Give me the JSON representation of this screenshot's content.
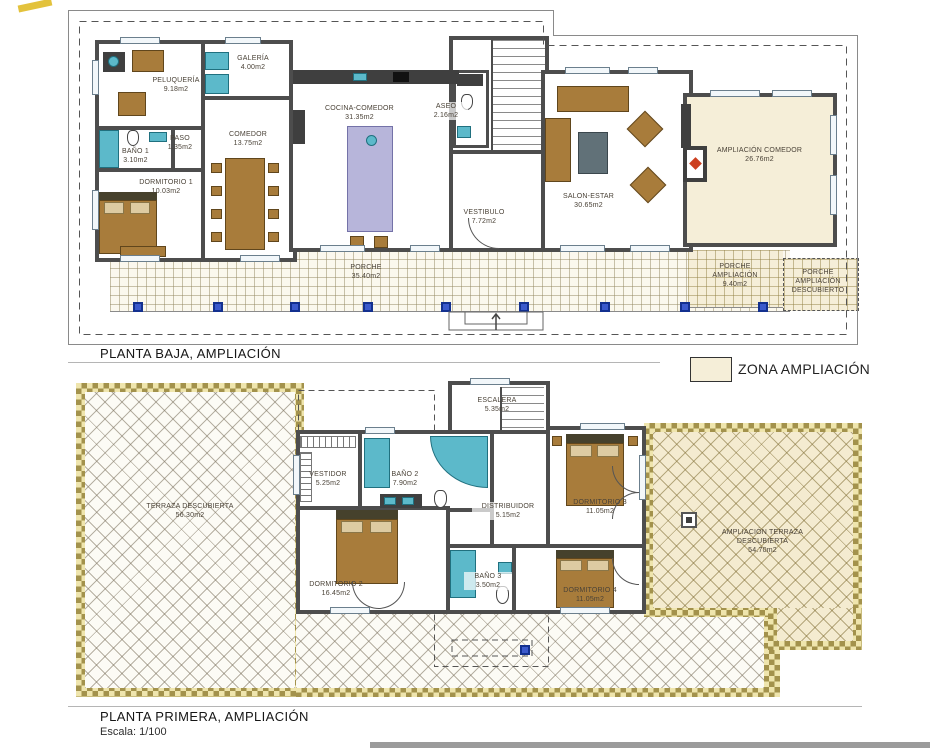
{
  "titles": {
    "plan1": "PLANTA BAJA, AMPLIACIÓN",
    "plan2": "PLANTA PRIMERA, AMPLIACIÓN",
    "scale": "Escala: 1/100"
  },
  "legend": {
    "label": "ZONA AMPLIACIÓN",
    "swatch_color": "#F5EED8"
  },
  "colors": {
    "wall": "#4D4D4D",
    "ampliacion_fill": "#F5EED8",
    "terrace_border_gold": "#A3924C",
    "fixture_teal": "#5CB9CA",
    "furniture_brown": "#A87C3B",
    "column_blue": "#3B59CC"
  },
  "plan1": {
    "rooms": {
      "peluqueria": {
        "name": "PELUQUERÍA",
        "area": "9.18m2"
      },
      "galeria": {
        "name": "GALERÍA",
        "area": "4.00m2"
      },
      "paso": {
        "name": "PASO",
        "area": "1.35m2"
      },
      "bano1": {
        "name": "BAÑO 1",
        "area": "3.10m2"
      },
      "dormitorio1": {
        "name": "DORMITORIO 1",
        "area": "10.03m2"
      },
      "comedor": {
        "name": "COMEDOR",
        "area": "13.75m2"
      },
      "cocina": {
        "name": "COCINA-COMEDOR",
        "area": "31.35m2"
      },
      "aseo": {
        "name": "ASEO",
        "area": "2.16m2"
      },
      "vestibulo": {
        "name": "VESTIBULO",
        "area": "7.72m2"
      },
      "salon": {
        "name": "SALON-ESTAR",
        "area": "30.65m2"
      },
      "ampliacion_comedor": {
        "name": "AMPLIACIÓN COMEDOR",
        "area": "26.76m2"
      },
      "porche": {
        "name": "PORCHE",
        "area": "35.40m2"
      },
      "porche_ampliacion": {
        "name": "PORCHE AMPLIACIÓN",
        "area": "9.40m2"
      },
      "porche_descubierto": {
        "name": "PORCHE AMPLIACIÓN DESCUBIERTO",
        "area": ""
      }
    }
  },
  "plan2": {
    "rooms": {
      "escalera": {
        "name": "ESCALERA",
        "area": "5.35m2"
      },
      "vestidor": {
        "name": "VESTIDOR",
        "area": "5.25m2"
      },
      "bano2": {
        "name": "BAÑO 2",
        "area": "7.90m2"
      },
      "distribuidor": {
        "name": "DISTRIBUIDOR",
        "area": "5.15m2"
      },
      "dormitorio3": {
        "name": "DORMITORIO 3",
        "area": "11.05m2"
      },
      "dormitorio2": {
        "name": "DORMITORIO 2",
        "area": "16.45m2"
      },
      "bano3": {
        "name": "BAÑO 3",
        "area": "3.50m2"
      },
      "dormitorio4": {
        "name": "DORMITORIO 4",
        "area": "11.05m2"
      },
      "terraza": {
        "name": "TERRAZA DESCUBIERTA",
        "area": "56.30m2"
      },
      "ampliacion_terraza": {
        "name": "AMPLIACIÓN TERRAZA DESCUBIERTA",
        "area": "54.70m2"
      }
    }
  }
}
